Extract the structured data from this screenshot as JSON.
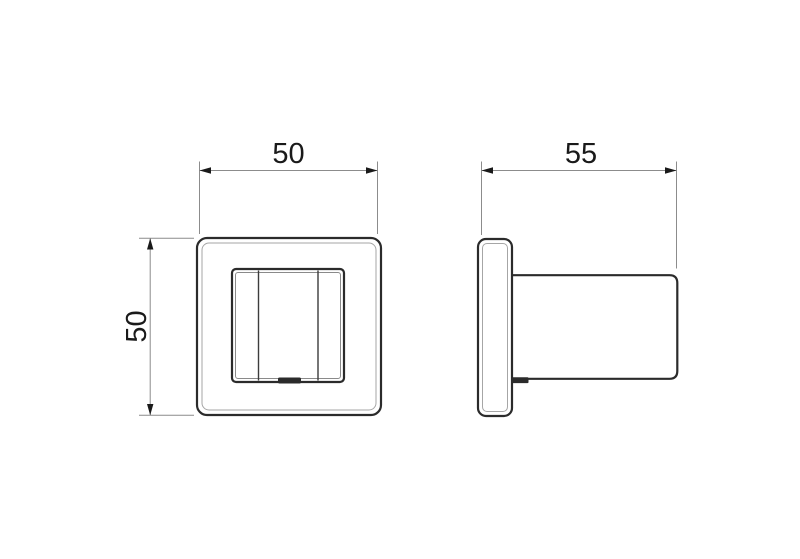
{
  "drawing": {
    "type": "technical-dimension-drawing",
    "subject": "square wall hook / robe hook, front and side views",
    "background_color": "#ffffff",
    "outline_color": "#2b2b2b",
    "detail_line_color": "#8a8a8a",
    "dimension_line_color": "#8c8c8c",
    "text_color": "#1a1a1a"
  },
  "dimensions": {
    "front_width": "50",
    "front_height": "50",
    "side_depth": "55"
  }
}
